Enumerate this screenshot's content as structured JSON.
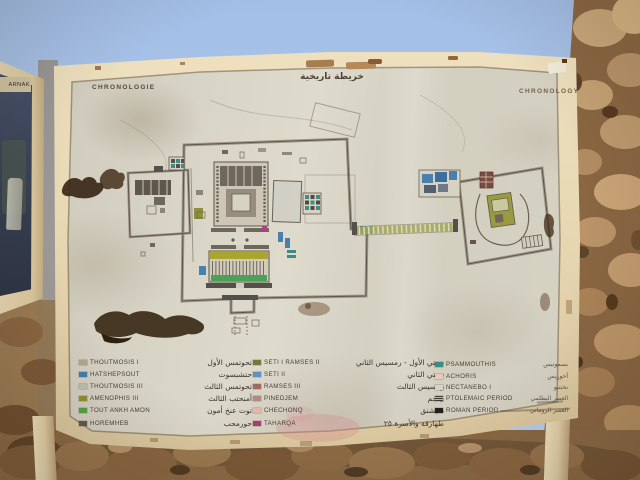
{
  "scene": {
    "neighbor_sign_label": "ARNAK",
    "palette": {
      "sky": "#abc4e8",
      "frame": "#e9dab6",
      "face": "#d7d3c5",
      "wall": "#c29c70",
      "ground": "#8a6844"
    }
  },
  "board": {
    "title_left": "CHRONOLOGIE",
    "title_center_ar": "خريطة تاريخية",
    "title_right": "CHRONOLOGY"
  },
  "legend": {
    "groups": [
      {
        "rows": [
          {
            "en": "THOUTMOSIS  I",
            "ar": "تحوتمس الأول",
            "color": "#b3a78e"
          },
          {
            "en": "HATSHEPSOUT",
            "ar": "حتشبسوت",
            "color": "#3d7fb0"
          },
          {
            "en": "THOUTMOSIS  III",
            "ar": "تحوتمس الثالث",
            "color": "#bcc2ae"
          },
          {
            "en": "AMENOPHIS  III",
            "ar": "أمنحتب الثالث",
            "color": "#8f8f2f"
          },
          {
            "en": "TOUT ANKH AMON",
            "ar": "توت عنخ أمون",
            "color": "#57a046"
          },
          {
            "en": "HOREMHEB",
            "ar": "حورمحب",
            "color": "#5b5b52"
          }
        ]
      },
      {
        "rows": [
          {
            "en": "SETI  I   RAMSES  II",
            "ar": "سيتي الأول - رمسيس الثاني",
            "color": "#6f7a3c"
          },
          {
            "en": "SETI  II",
            "ar": "سيتي الثاني",
            "color": "#5d92c2"
          },
          {
            "en": "RAMSES  III",
            "ar": "رمسيس الثالث",
            "color": "#a06a5c"
          },
          {
            "en": "PINEDJEM",
            "ar": "بينجم",
            "color": "#b28c80"
          },
          {
            "en": "CHECHONQ",
            "ar": "شيشنق",
            "color": "#e2b6a8"
          },
          {
            "en": "TAHARQA",
            "ar": "طهارقة والأسرة ٢٥",
            "color": "#aa3c7c"
          }
        ]
      },
      {
        "rows": [
          {
            "en": "PSAMMOUTHIS",
            "ar": "بسموتيس",
            "color": "#3d8c88"
          },
          {
            "en": "ACHORIS",
            "ar": "أخوريس",
            "color": "#e7c9be"
          },
          {
            "en": "NECTANEBO  I",
            "ar": "نختنبو",
            "color": "#d3d3c6"
          },
          {
            "en": "PTOLEMAIC  PERIOD",
            "ar": "العصر البطلمي",
            "color": "#6c6c64",
            "hatched": true
          },
          {
            "en": "ROMAN  PERIOD",
            "ar": "العصر الروماني",
            "color": "#22201c"
          }
        ]
      }
    ]
  }
}
